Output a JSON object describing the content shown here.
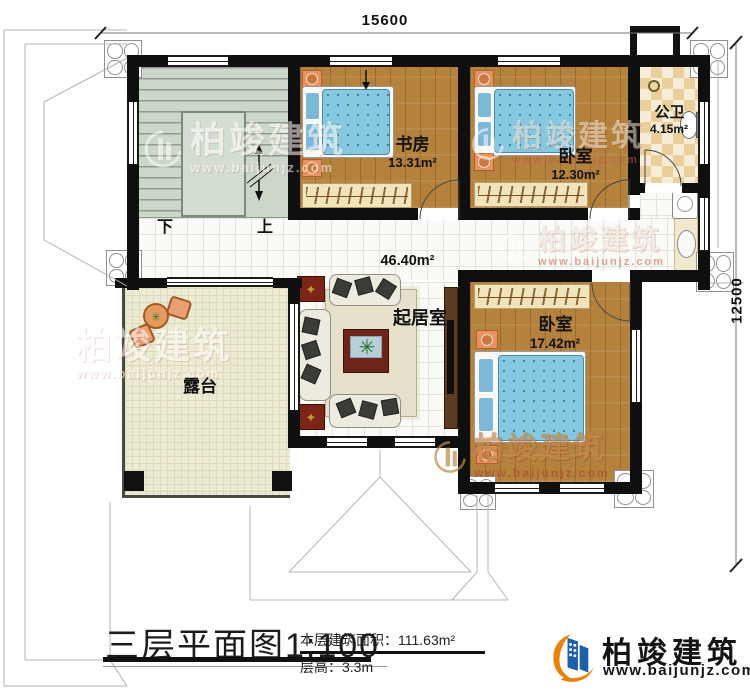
{
  "dimensions": {
    "top": "15600",
    "right": "12500"
  },
  "stairs": {
    "down": "下",
    "up": "上"
  },
  "rooms": {
    "study": {
      "name": "书房",
      "area": "13.31m²"
    },
    "bedroom_top": {
      "name": "卧室",
      "area": "12.30m²"
    },
    "bathroom": {
      "name": "公卫",
      "area": "4.15m²"
    },
    "living": {
      "name": "起居室",
      "area": "46.40m²"
    },
    "bedroom_bottom": {
      "name": "卧室",
      "area": "17.42m²"
    },
    "terrace": {
      "name": "露台"
    }
  },
  "watermark": {
    "brand": "柏竣建筑",
    "url": "www.baijunjz.com"
  },
  "title_block": {
    "title": "三层平面图1:100",
    "area_line": "本层建筑面积：111.63m²",
    "height_line": "层高：3.3m"
  },
  "logo": {
    "name": "柏竣建筑",
    "url": "www.baijunjz.com"
  },
  "colors": {
    "brand_blue": "#1d5fa8",
    "brand_orange": "#e8820c",
    "wall": "#0f0f0f",
    "wood_floor": "#b5823e",
    "bed_blue": "#85c8df",
    "stairs": "#ccd7ca",
    "terrace": "#edebd3",
    "bath_checker": "#e9cf9b"
  }
}
